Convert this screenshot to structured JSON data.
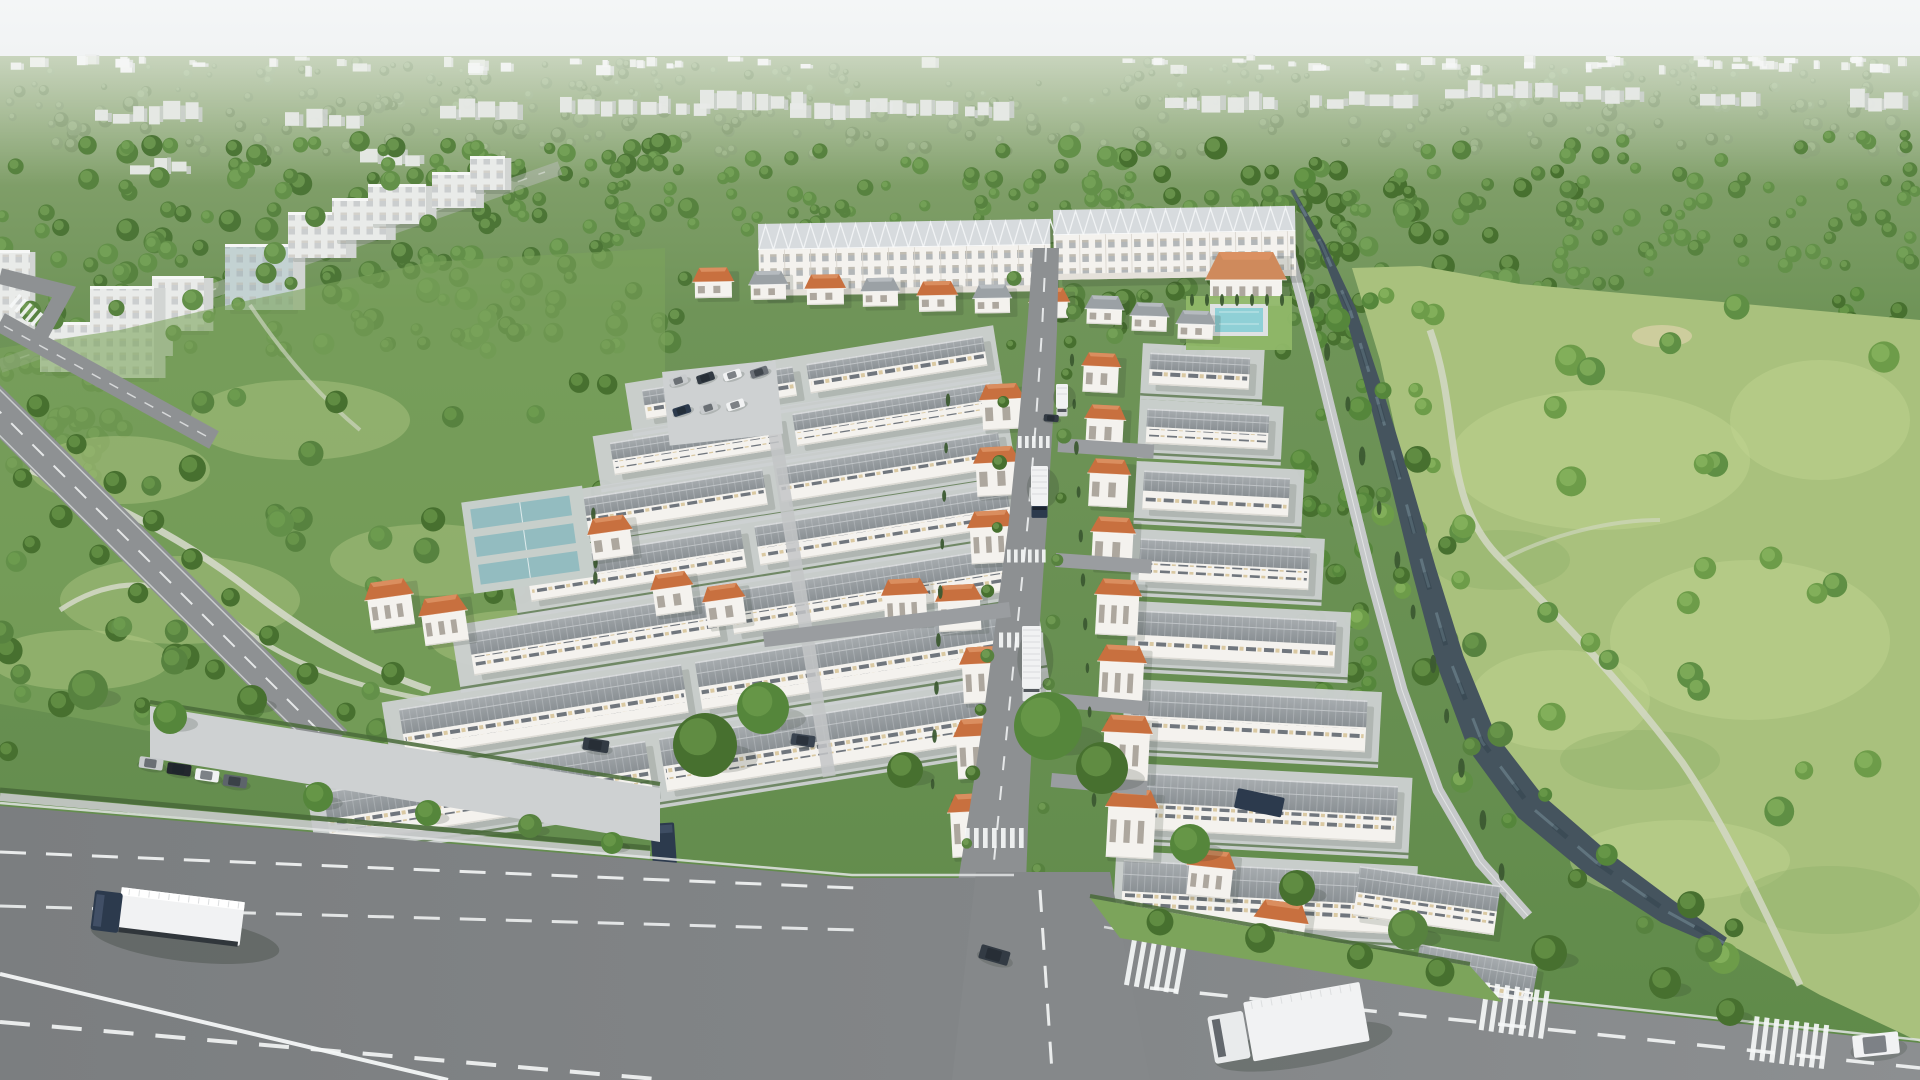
{
  "meta": {
    "title": "Aerial masterplan rendering",
    "description": "Aerial 3D architectural rendering of a suburban masterplan estate: long white shophouse blocks with glazed roofs at the rear, dense rows of white warehouses with grey ridged roofs, orange-tile-roofed townhouses lining a central street, tennis courts and a swimming pool, all wrapped by deep green forest; a tree-lined canal and an open meadow with a dirt path on the right; wide grey asphalt roads with lane markings, crosswalks, trucks and cars in the foreground; hazy city skyline on the horizon under a pale overcast sky.",
    "render_style": "photorealistic CGI, overcast daylight",
    "view": "high-angle aerial oblique"
  },
  "scene": {
    "regions": [
      "pale overcast sky",
      "hazy city skyline on horizon",
      "far forest belt with scattered white buildings",
      "mid-rise city blocks among trees (upper left)",
      "public park with winding paths and tree-lined boulevard (left)",
      "masterplan development: shophouse terraces, warehouse rows, orange-roof townhouses, tennis courts, swimming pool, parking lots",
      "central north-south street with box trucks and zebra crossings",
      "tree-lined canal flowing to the south-east",
      "open meadow with winding dirt path (right)",
      "wide foreground roads with dashed lane lines, crosswalks, semi-trailer truck, box truck and cars"
    ]
  },
  "vehicles": {
    "semi_trailer_text": "BLUE TRANS"
  },
  "palette": {
    "sky_top": "#f4f6f7",
    "sky_bottom": "#e7eaeb",
    "haze": "#eef1ef",
    "ground_top": "#8fa878",
    "ground_bot": "#5f8a49",
    "meadow": "#a9c17d",
    "meadow_light": "#c2d593",
    "meadow_dark": "#8fae69",
    "path": "#d9dccf",
    "sand": "#d9d0a8",
    "water": "#45545e",
    "water_light": "#8aa4b0",
    "road": "#8c8f91",
    "road_dark": "#7b7e80",
    "road_light": "#9b9ea0",
    "concrete": "#ced1d2",
    "sidewalk": "#c7c9ca",
    "curb": "#e3e5e5",
    "marking": "#f5f7f7",
    "wall": "#f4f2ee",
    "wall_shade": "#dddbd5",
    "roof_top": "#a8adb0",
    "roof_bot": "#8a9094",
    "roof_rib": "#c6cacd",
    "glass_roof": "#d7dbde",
    "glass_frame": "#f2f4f5",
    "window_dark": "#59616a",
    "window_lit": "#d8c59a",
    "window_city": "#9aa0a5",
    "orange_roof": "#c8703f",
    "orange_roof_light": "#dc9163",
    "orange_roof_dark": "#9c5128",
    "hedge": "#4a6b3a",
    "cypress": "#3c5a31",
    "court": "#93bcc0",
    "court_deck": "#c7cfcb",
    "pool": "#8fd0d6",
    "pool_deck": "#dfe2e3",
    "lawn": "#8fb768",
    "truck_cab": "#2c3a4d",
    "vehicle_dark": "#333b44",
    "vehicle_silver": "#c8cbcd",
    "vehicle_white": "#f1f2f3",
    "shadow": "#283326",
    "city_block": "#e9ebe9",
    "city_block_side": "#d2d5d3",
    "tree_far_base": "#7f9b6b",
    "tree_far_hi": "#a3bd8d",
    "tree_mid_base": "#57823f",
    "tree_mid_hi": "#82ad60",
    "tree_rich_base": "#47702f",
    "tree_rich_hi": "#74a452",
    "tree_meadow_base": "#6d9c49",
    "tree_meadow_hi": "#93c068"
  }
}
